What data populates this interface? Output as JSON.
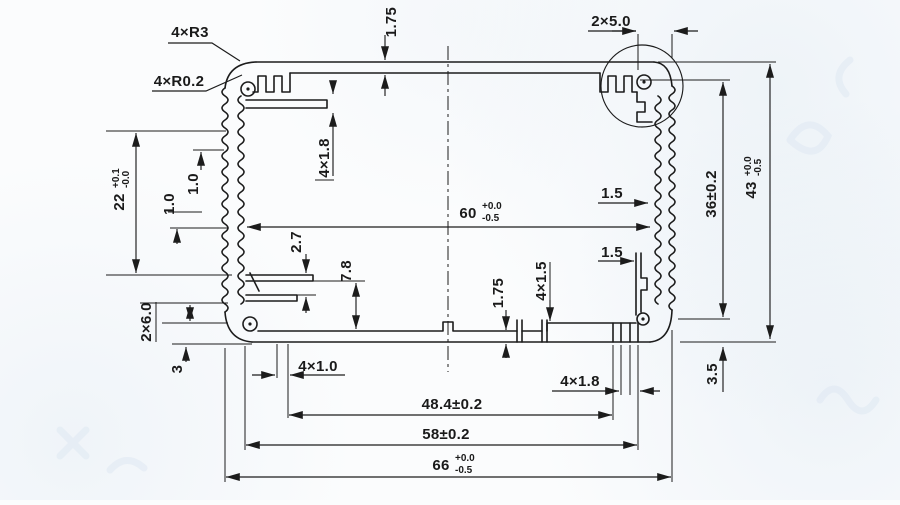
{
  "colors": {
    "ink": "#1c1c1c",
    "paper": "#fbfcfd",
    "watermark": "#dfe8f2"
  },
  "dims": {
    "corner_radius": "4×R3",
    "fillet_radius": "4×R0.2",
    "top_wall_thickness": "1.75",
    "corner_notch": "2×5.0",
    "rib_slot_left": "4×1.8",
    "fin_pitch_upper": "1.0",
    "fin_pitch_lower": "1.0",
    "pcb_slot_gap": "2.7",
    "pcb_slot_depth": "7.8",
    "wall_right_upper": "1.5",
    "wall_right_lower": "1.5",
    "boss_span_height": "36±0.2",
    "bottom_wall_thickness": "1.75",
    "screw_slot_center": "4×1.5",
    "left_step": "2×6.0",
    "bottom_left_wall": "3",
    "slot_width_left": "4×1.0",
    "slot_width_right": "4×1.8",
    "hole_span_width": "48.4±0.2",
    "inner_span_width": "58±0.2",
    "corner_step_right": "3.5"
  },
  "tol_dims": {
    "left_channel_height": {
      "value": "22",
      "upper": "+0.1",
      "lower": "-0.0"
    },
    "inner_width": {
      "value": "60",
      "upper": "+0.0",
      "lower": "-0.5"
    },
    "overall_height": {
      "value": "43",
      "upper": "+0.0",
      "lower": "-0.5"
    },
    "overall_width": {
      "value": "66",
      "upper": "+0.0",
      "lower": "-0.5"
    }
  }
}
